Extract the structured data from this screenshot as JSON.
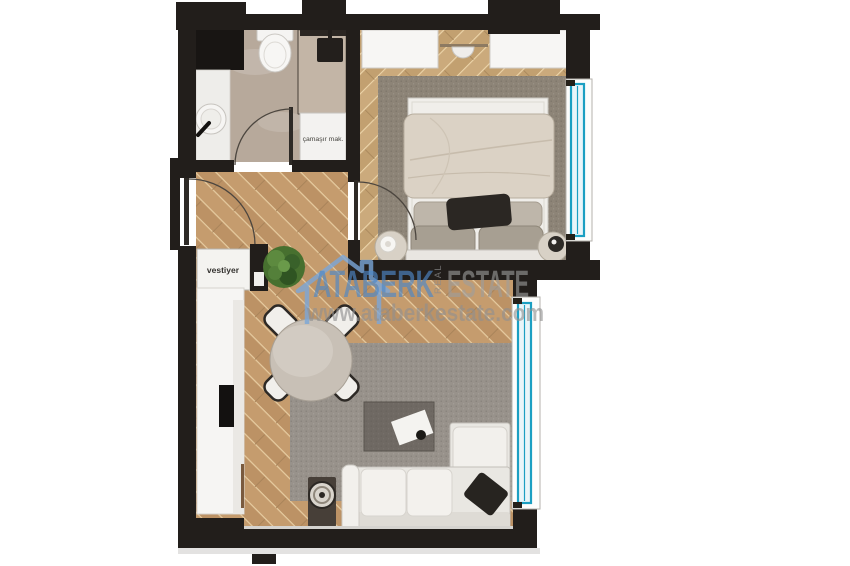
{
  "page": {
    "background": "#ffffff"
  },
  "plan": {
    "labels": {
      "laundry": "çamaşır mak.",
      "vestiyer": "vestiyer"
    },
    "watermark": {
      "brand_primary": "ATABERK",
      "brand_vertical": "REAL",
      "brand_secondary": "ESTATE",
      "website": "www.ataberkestate.com"
    },
    "colors": {
      "wall": "#221e1b",
      "window_accent": "#1b9fc2",
      "wood_floor": "#c59c6e",
      "bedroom_wood_floor": "#cbaa7c",
      "bathroom_floor": "#b7a99b",
      "shower_floor": "#c3b5a6",
      "bedroom_rug": "#8d8477",
      "living_rug": "#98928b",
      "watermark_blue": "#4e88c7",
      "watermark_gray": "#9e9e9e",
      "background": "#ffffff"
    }
  }
}
